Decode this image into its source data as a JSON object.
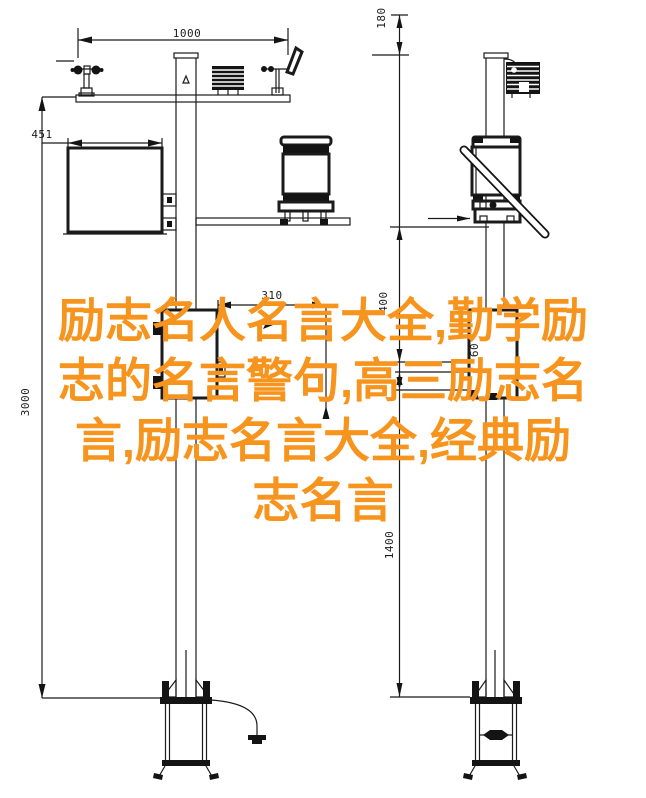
{
  "overlay": {
    "color": "#f7941d",
    "lines": [
      "励志名人名言大全,勤学励",
      "志的名言警句,高三励志名",
      "言,励志名言大全,经典励",
      "志名言"
    ]
  },
  "dims": {
    "crossarm_span": "1000",
    "top_offset": "180",
    "box_width": "451",
    "mid_offset": "310",
    "total_height": "3000",
    "upper_segment": "400",
    "small_segment": "60",
    "lower_segment": "1400"
  }
}
